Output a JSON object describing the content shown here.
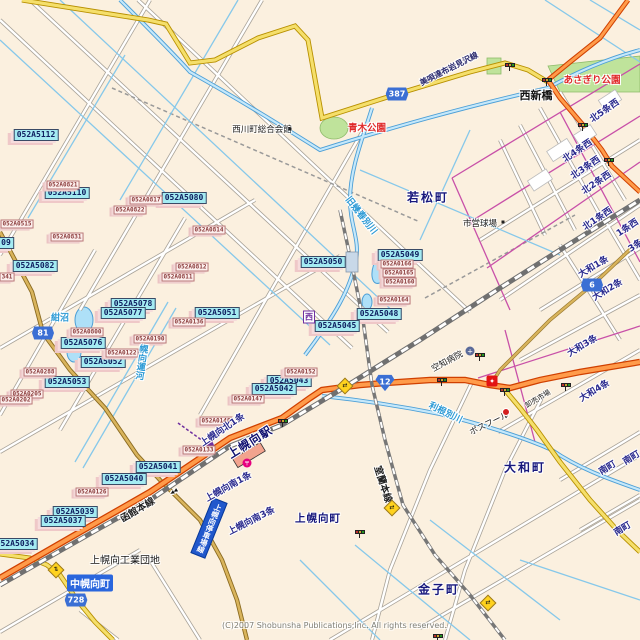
{
  "map": {
    "copyright": "(C)2007 Shobunsha Publications,Inc. All rights reserved.",
    "banner": {
      "text": "上幌向停車場線"
    },
    "colors": {
      "background": "#FBF0DF",
      "national_road": "#FF9B4A",
      "pref_road_yellow": "#F5DF6B",
      "shield_blue": "#3B6FD4",
      "water_fill": "#C5E8FA",
      "park_green": "#BFE39B",
      "marker_cyan": "#A4EBF2",
      "marker_pink": "#FDF0EE",
      "town_text": "#18187D"
    },
    "shields": [
      {
        "n": "387",
        "x": 397,
        "y": 94,
        "kind": "pref"
      },
      {
        "n": "6",
        "x": 592,
        "y": 285,
        "kind": "pref"
      },
      {
        "n": "81",
        "x": 43,
        "y": 333,
        "kind": "pref"
      },
      {
        "n": "728",
        "x": 76,
        "y": 600,
        "kind": "pref"
      },
      {
        "n": "12",
        "x": 385,
        "y": 383,
        "kind": "national"
      }
    ],
    "point_labels": [
      {
        "t": "052A5112",
        "x": 36,
        "y": 135
      },
      {
        "t": "052A5110",
        "x": 67,
        "y": 193
      },
      {
        "t": "052A5080",
        "x": 184,
        "y": 198
      },
      {
        "t": "052A5082",
        "x": 35,
        "y": 266
      },
      {
        "t": "09",
        "x": 6,
        "y": 243
      },
      {
        "t": "052A5050",
        "x": 323,
        "y": 262
      },
      {
        "t": "052A5049",
        "x": 400,
        "y": 255
      },
      {
        "t": "052A5048",
        "x": 379,
        "y": 314
      },
      {
        "t": "052A5045",
        "x": 337,
        "y": 326
      },
      {
        "t": "052A5078",
        "x": 133,
        "y": 304
      },
      {
        "t": "052A5077",
        "x": 123,
        "y": 313
      },
      {
        "t": "052A5051",
        "x": 217,
        "y": 313
      },
      {
        "t": "052A5076",
        "x": 83,
        "y": 343
      },
      {
        "t": "052A5052",
        "x": 103,
        "y": 362
      },
      {
        "t": "052A5053",
        "x": 67,
        "y": 382
      },
      {
        "t": "052A5043",
        "x": 289,
        "y": 381
      },
      {
        "t": "052A5042",
        "x": 274,
        "y": 389
      },
      {
        "t": "052A5041",
        "x": 158,
        "y": 467
      },
      {
        "t": "052A5040",
        "x": 124,
        "y": 479
      },
      {
        "t": "052A5039",
        "x": 75,
        "y": 512
      },
      {
        "t": "052A5037",
        "x": 63,
        "y": 521
      },
      {
        "t": "052A5034",
        "x": 15,
        "y": 544
      }
    ],
    "ref_labels": [
      {
        "t": "052A0821",
        "x": 63,
        "y": 185
      },
      {
        "t": "052A0515",
        "x": 17,
        "y": 224
      },
      {
        "t": "052A0817",
        "x": 146,
        "y": 200
      },
      {
        "t": "052A0822",
        "x": 130,
        "y": 210
      },
      {
        "t": "052A0831",
        "x": 67,
        "y": 237
      },
      {
        "t": "052A0814",
        "x": 209,
        "y": 230
      },
      {
        "t": "052A0812",
        "x": 192,
        "y": 267
      },
      {
        "t": "052A0811",
        "x": 178,
        "y": 277
      },
      {
        "t": "052A0166",
        "x": 397,
        "y": 264
      },
      {
        "t": "052A0165",
        "x": 399,
        "y": 273
      },
      {
        "t": "052A0160",
        "x": 400,
        "y": 282
      },
      {
        "t": "052A0164",
        "x": 394,
        "y": 300
      },
      {
        "t": "052A0136",
        "x": 189,
        "y": 322
      },
      {
        "t": "052A0800",
        "x": 87,
        "y": 332
      },
      {
        "t": "052A0190",
        "x": 150,
        "y": 339
      },
      {
        "t": "052A0122",
        "x": 122,
        "y": 353
      },
      {
        "t": "052A0288",
        "x": 40,
        "y": 372
      },
      {
        "t": "052A0205",
        "x": 27,
        "y": 394
      },
      {
        "t": "052A0202",
        "x": 16,
        "y": 400
      },
      {
        "t": "052A0152",
        "x": 301,
        "y": 372
      },
      {
        "t": "052A0147",
        "x": 248,
        "y": 399
      },
      {
        "t": "052A0148",
        "x": 216,
        "y": 421
      },
      {
        "t": "052A0133",
        "x": 199,
        "y": 450
      },
      {
        "t": "052A0126",
        "x": 92,
        "y": 492
      },
      {
        "t": "341",
        "x": 7,
        "y": 277
      }
    ],
    "labels": [
      {
        "t": "若松町",
        "x": 428,
        "y": 197,
        "rot": 0,
        "cls": "town"
      },
      {
        "t": "大和町",
        "x": 525,
        "y": 467,
        "rot": 0,
        "cls": "town"
      },
      {
        "t": "金子町",
        "x": 439,
        "y": 589,
        "rot": 0,
        "cls": "town"
      },
      {
        "t": "上幌向町",
        "x": 318,
        "y": 518,
        "rot": 0,
        "cls": "town-sm"
      },
      {
        "t": "上幌向工業団地",
        "x": 125,
        "y": 559,
        "rot": 0,
        "cls": "black-md"
      },
      {
        "t": "西新橋",
        "x": 536,
        "y": 95,
        "rot": 0,
        "cls": "black-bold"
      },
      {
        "t": "西川町総合会館",
        "x": 262,
        "y": 129,
        "rot": 0,
        "cls": "black-sm"
      },
      {
        "t": "市営球場",
        "x": 480,
        "y": 223,
        "rot": 0,
        "cls": "black-sm"
      },
      {
        "t": "あさぎり公園",
        "x": 592,
        "y": 79,
        "rot": 0,
        "cls": "red"
      },
      {
        "t": "青木公園",
        "x": 367,
        "y": 127,
        "rot": 0,
        "cls": "red"
      },
      {
        "t": "紺沼",
        "x": 60,
        "y": 317,
        "rot": 0,
        "cls": "water"
      },
      {
        "t": "旧幾春別川",
        "x": 362,
        "y": 215,
        "rot": 52,
        "cls": "water"
      },
      {
        "t": "利根別川",
        "x": 446,
        "y": 412,
        "rot": 26,
        "cls": "water"
      },
      {
        "t": "幌向運河",
        "x": 141,
        "y": 362,
        "rot": 8,
        "cls": "water-v"
      },
      {
        "t": "函館本線",
        "x": 137,
        "y": 509,
        "rot": -31,
        "cls": "rail"
      },
      {
        "t": "室蘭本線",
        "x": 384,
        "y": 484,
        "rot": 72,
        "cls": "rail"
      },
      {
        "t": "空知病院",
        "x": 447,
        "y": 361,
        "rot": -28,
        "cls": "black-sm"
      },
      {
        "t": "卸売市場",
        "x": 538,
        "y": 399,
        "rot": -31,
        "cls": "black-xs"
      },
      {
        "t": "ポスフール",
        "x": 489,
        "y": 423,
        "rot": -26,
        "cls": "black-sm"
      },
      {
        "t": "美唄達布岩見沢線",
        "x": 449,
        "y": 69,
        "rot": -27,
        "cls": "roadname"
      },
      {
        "t": "上幌向駅",
        "x": 250,
        "y": 442,
        "rot": -32,
        "cls": "station"
      },
      {
        "t": "上幌向北1条",
        "x": 222,
        "y": 429,
        "rot": -34,
        "cls": "jo"
      },
      {
        "t": "上幌向南1条",
        "x": 228,
        "y": 486,
        "rot": -29,
        "cls": "jo"
      },
      {
        "t": "上幌向南3条",
        "x": 251,
        "y": 520,
        "rot": -27,
        "cls": "jo"
      },
      {
        "t": "北5条西",
        "x": 604,
        "y": 110,
        "rot": -35,
        "cls": "jo"
      },
      {
        "t": "北4条西",
        "x": 577,
        "y": 150,
        "rot": -34,
        "cls": "jo"
      },
      {
        "t": "北3条西",
        "x": 585,
        "y": 167,
        "rot": -34,
        "cls": "jo"
      },
      {
        "t": "北2条西",
        "x": 596,
        "y": 182,
        "rot": -34,
        "cls": "jo"
      },
      {
        "t": "北1条西",
        "x": 597,
        "y": 218,
        "rot": -34,
        "cls": "jo"
      },
      {
        "t": "1条西",
        "x": 627,
        "y": 227,
        "rot": -34,
        "cls": "jo"
      },
      {
        "t": "3条",
        "x": 635,
        "y": 245,
        "rot": -34,
        "cls": "jo"
      },
      {
        "t": "大和1条",
        "x": 593,
        "y": 266,
        "rot": -31,
        "cls": "jo"
      },
      {
        "t": "大和2条",
        "x": 607,
        "y": 289,
        "rot": -31,
        "cls": "jo"
      },
      {
        "t": "大和3条",
        "x": 582,
        "y": 345,
        "rot": -31,
        "cls": "jo"
      },
      {
        "t": "大和4条",
        "x": 594,
        "y": 390,
        "rot": -31,
        "cls": "jo"
      },
      {
        "t": "南町",
        "x": 607,
        "y": 467,
        "rot": -31,
        "cls": "jo"
      },
      {
        "t": "南町",
        "x": 631,
        "y": 457,
        "rot": -31,
        "cls": "jo"
      },
      {
        "t": "南町",
        "x": 622,
        "y": 528,
        "rot": -31,
        "cls": "jo"
      },
      {
        "t": "中幌向町",
        "x": 90,
        "y": 583,
        "rot": 0,
        "cls": "bluebox"
      },
      {
        "t": "西",
        "x": 309,
        "y": 317,
        "rot": 0,
        "cls": "purplebox"
      },
      {
        "t": "◀◀",
        "x": 174,
        "y": 492,
        "rot": -31,
        "cls": "tiny"
      }
    ],
    "signals": [
      {
        "x": 510,
        "y": 65
      },
      {
        "x": 547,
        "y": 80
      },
      {
        "x": 583,
        "y": 125
      },
      {
        "x": 609,
        "y": 160
      },
      {
        "x": 283,
        "y": 421
      },
      {
        "x": 442,
        "y": 380
      },
      {
        "x": 480,
        "y": 355
      },
      {
        "x": 505,
        "y": 390
      },
      {
        "x": 566,
        "y": 385
      },
      {
        "x": 360,
        "y": 532
      },
      {
        "x": 438,
        "y": 636
      }
    ],
    "diamonds": [
      {
        "x": 56,
        "y": 570,
        "g": "⇅"
      },
      {
        "x": 345,
        "y": 386,
        "g": "⇄"
      },
      {
        "x": 392,
        "y": 508,
        "g": "⇄"
      },
      {
        "x": 488,
        "y": 603,
        "g": "⇄"
      }
    ],
    "pois": [
      {
        "x": 247,
        "y": 463,
        "type": "post-office",
        "glyph": "〒"
      },
      {
        "x": 470,
        "y": 351,
        "type": "hospital",
        "glyph": "+"
      },
      {
        "x": 492,
        "y": 381,
        "type": "shopping-center",
        "glyph": "✦"
      },
      {
        "x": 506,
        "y": 412,
        "type": "store-dot",
        "glyph": ""
      },
      {
        "x": 290,
        "y": 129,
        "type": "building-dot",
        "glyph": ""
      },
      {
        "x": 503,
        "y": 222,
        "type": "poi-dot",
        "glyph": ""
      }
    ]
  }
}
